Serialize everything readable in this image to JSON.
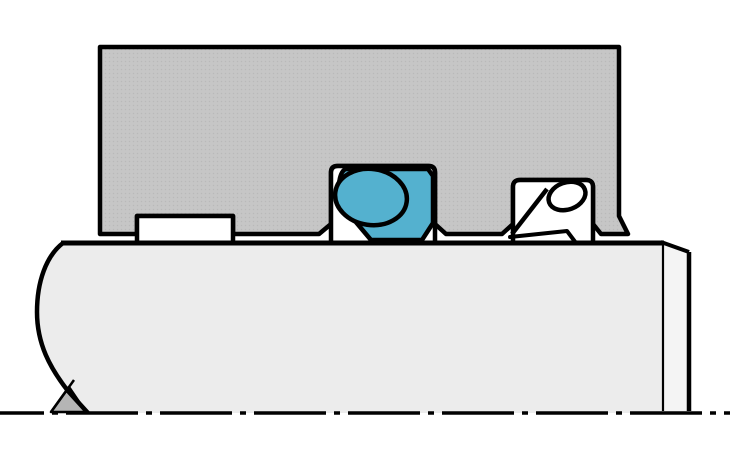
{
  "diagram": {
    "kind": "sectional-technical-drawing",
    "subject": "rod-seal-assembly-cross-section",
    "components": {
      "housing": "gland-housing",
      "guide_ring": "guide-ring",
      "rod_seal_body": "slide-ring-seal",
      "rod_seal_oring": "o-ring-energizer",
      "wiper": "wiper-seal",
      "wiper_oring": "wiper-o-ring",
      "rod": "piston-rod",
      "center_mark": "center-drill-mark",
      "centerline": "rod-axis-centerline"
    },
    "colors": {
      "background": "#ffffff",
      "outline": "#000000",
      "housing_fill": "#c6c6c6",
      "housing_dot": "#b9b9b9",
      "rod_fill": "#ececec",
      "rod_chamfer_fill": "#f4f4f4",
      "seal_blue": "#54b1cf",
      "groove_white": "#ffffff",
      "center_mark_fill": "#b5b5b5"
    }
  }
}
